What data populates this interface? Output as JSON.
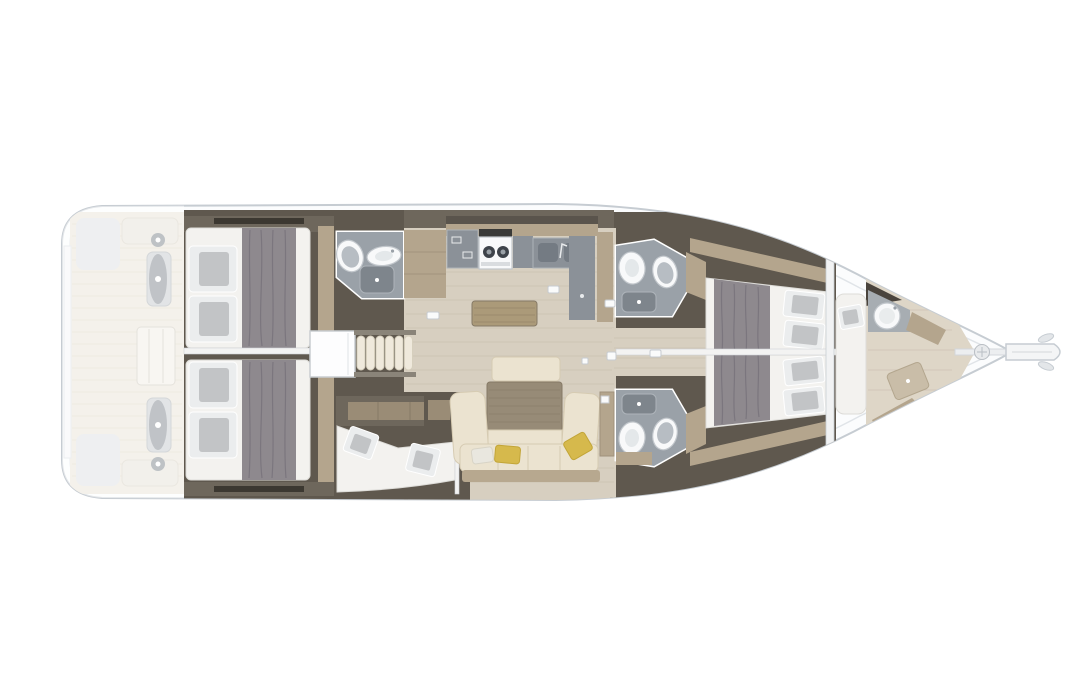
{
  "canvas": {
    "width": 1090,
    "height": 700,
    "background": "#ffffff"
  },
  "scene": {
    "type": "sailing-yacht-interior-floorplan",
    "orientation": "bow-right-stern-left",
    "regions": [
      "swim-platform",
      "cockpit-ghosted",
      "helm-station-port",
      "helm-station-starboard",
      "cockpit-table",
      "aft-cabin-port",
      "aft-cabin-starboard",
      "aft-head",
      "companionway-steps",
      "skipper-berth-cabin",
      "galley",
      "saloon-sofa",
      "saloon-table",
      "forward-head-port",
      "forward-head-starboard",
      "forward-cabin-port",
      "forward-cabin-starboard",
      "bow-crew-cabin",
      "windlass",
      "bowsprit"
    ],
    "fixtures": [
      "double-bed",
      "pillows",
      "duvet",
      "toilet",
      "sink",
      "shower-pan",
      "stove",
      "double-galley-sink",
      "fridge",
      "sofa-cushions",
      "steering-wheel"
    ]
  },
  "palette": {
    "bg": "#ffffff",
    "deckWhite": "#fbfcfd",
    "hullStroke": "#c6ccd2",
    "hullInner": "#e0e4e8",
    "ghostTeak": "#e9e3d6",
    "ghostLine": "#dcd4c3",
    "darkWall": "#5f584e",
    "darkWallLight": "#6e675c",
    "windowStrip": "#3c3831",
    "wood": "#b4a58d",
    "woodLight": "#cbbda4",
    "woodDark": "#9a8c76",
    "floor": "#d7cfc0",
    "floorLine": "#c6bcab",
    "floorFwd": "#ded6c7",
    "grayFixture": "#9aa1a8",
    "grayCounter": "#8b9198",
    "showerPan": "#7e858c",
    "basinGray": "#747b83",
    "fixtureWhite": "#f8f9fa",
    "fixtureStroke": "#c2c7cc",
    "seatGray": "#b7bdc3",
    "mattress": "#f3f2ef",
    "mattressEdge": "#dddcd8",
    "duvet": "#8e898e",
    "duvetLine": "#77727a",
    "pillowGray": "#c2c4c6",
    "pillowWhite": "#ebedee",
    "sofa": "#ebe3d0",
    "sofaEdge": "#d6cbb2",
    "saloonTable": "#978b77",
    "saloonTableLine": "#867a66",
    "midTable": "#ab9a79",
    "yellow": "#d6b94c",
    "yellowDeep": "#c2a538",
    "steps": "#efe9dc",
    "stepsEdge": "#d6cfbd",
    "rail": "#8a8479",
    "white": "#f4f5f6",
    "divider": "#f3f3f2",
    "pedestal": "#c4c8cc",
    "wheel": "#80878e",
    "hatch": "#fafbfb",
    "hatchStroke": "#c7cbd0",
    "bulkhead": "#f1f2f3"
  }
}
